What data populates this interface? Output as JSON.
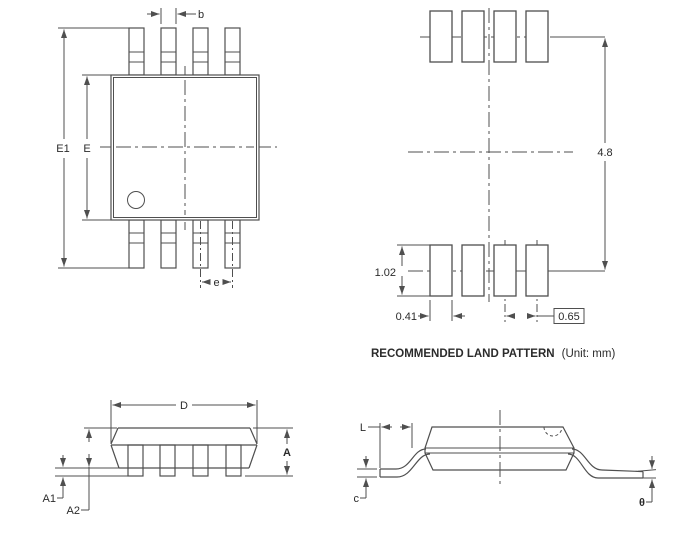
{
  "colors": {
    "line": "#4f4f4f",
    "text": "#2b2b2b",
    "bg": "#ffffff"
  },
  "views": {
    "top_view": {
      "labels": {
        "b": "b",
        "E1": "E1",
        "E": "E",
        "e": "e"
      }
    },
    "land_pattern": {
      "dims": {
        "lead_span": "4.8",
        "pad_height": "1.02",
        "pad_width": "0.41",
        "pad_pitch": "0.65"
      },
      "caption": {
        "title": "RECOMMENDED LAND PATTERN",
        "unit": "(Unit: mm)"
      }
    },
    "front_view": {
      "labels": {
        "D": "D",
        "A": "A",
        "A1": "A1",
        "A2": "A2"
      }
    },
    "profile_view": {
      "labels": {
        "L": "L",
        "c": "c",
        "theta": "θ"
      }
    }
  }
}
